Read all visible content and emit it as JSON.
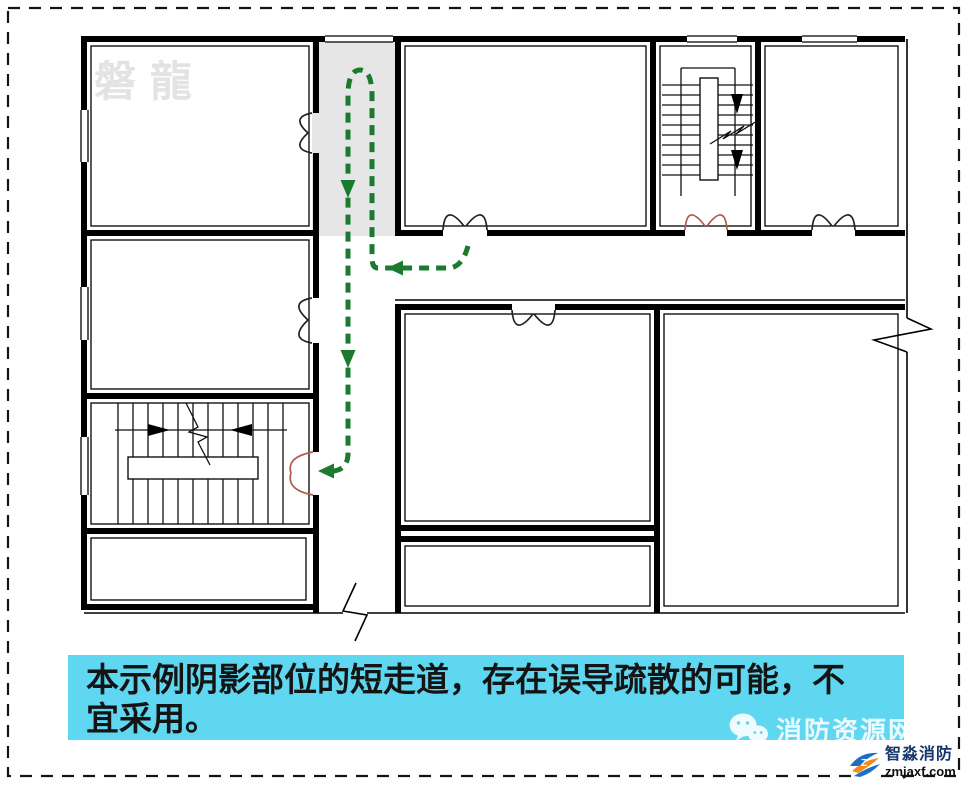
{
  "watermark": {
    "text": "磐龍"
  },
  "caption": {
    "text": "本示例阴影部位的短走道，存在误导疏散的可能，不宜采用。"
  },
  "branding": {
    "wechat_label": "消防资源网",
    "logo_name": "智淼消防",
    "logo_domain": "zmjaxf.com"
  },
  "colors": {
    "route_green": "#1b7a2d",
    "door_red": "#b05a50",
    "shade_gray": "#e6e6e6",
    "caption_cyan": "#5fd7f0",
    "border_black": "#141414",
    "wall_black": "#000000",
    "watermark_gray": "#e3e3e3",
    "logo_blue": "#1b6fc4",
    "logo_orange": "#f08a1d"
  },
  "icons": {
    "wechat": "wechat-bubbles-icon",
    "logo": "zm-swirl-logo"
  }
}
